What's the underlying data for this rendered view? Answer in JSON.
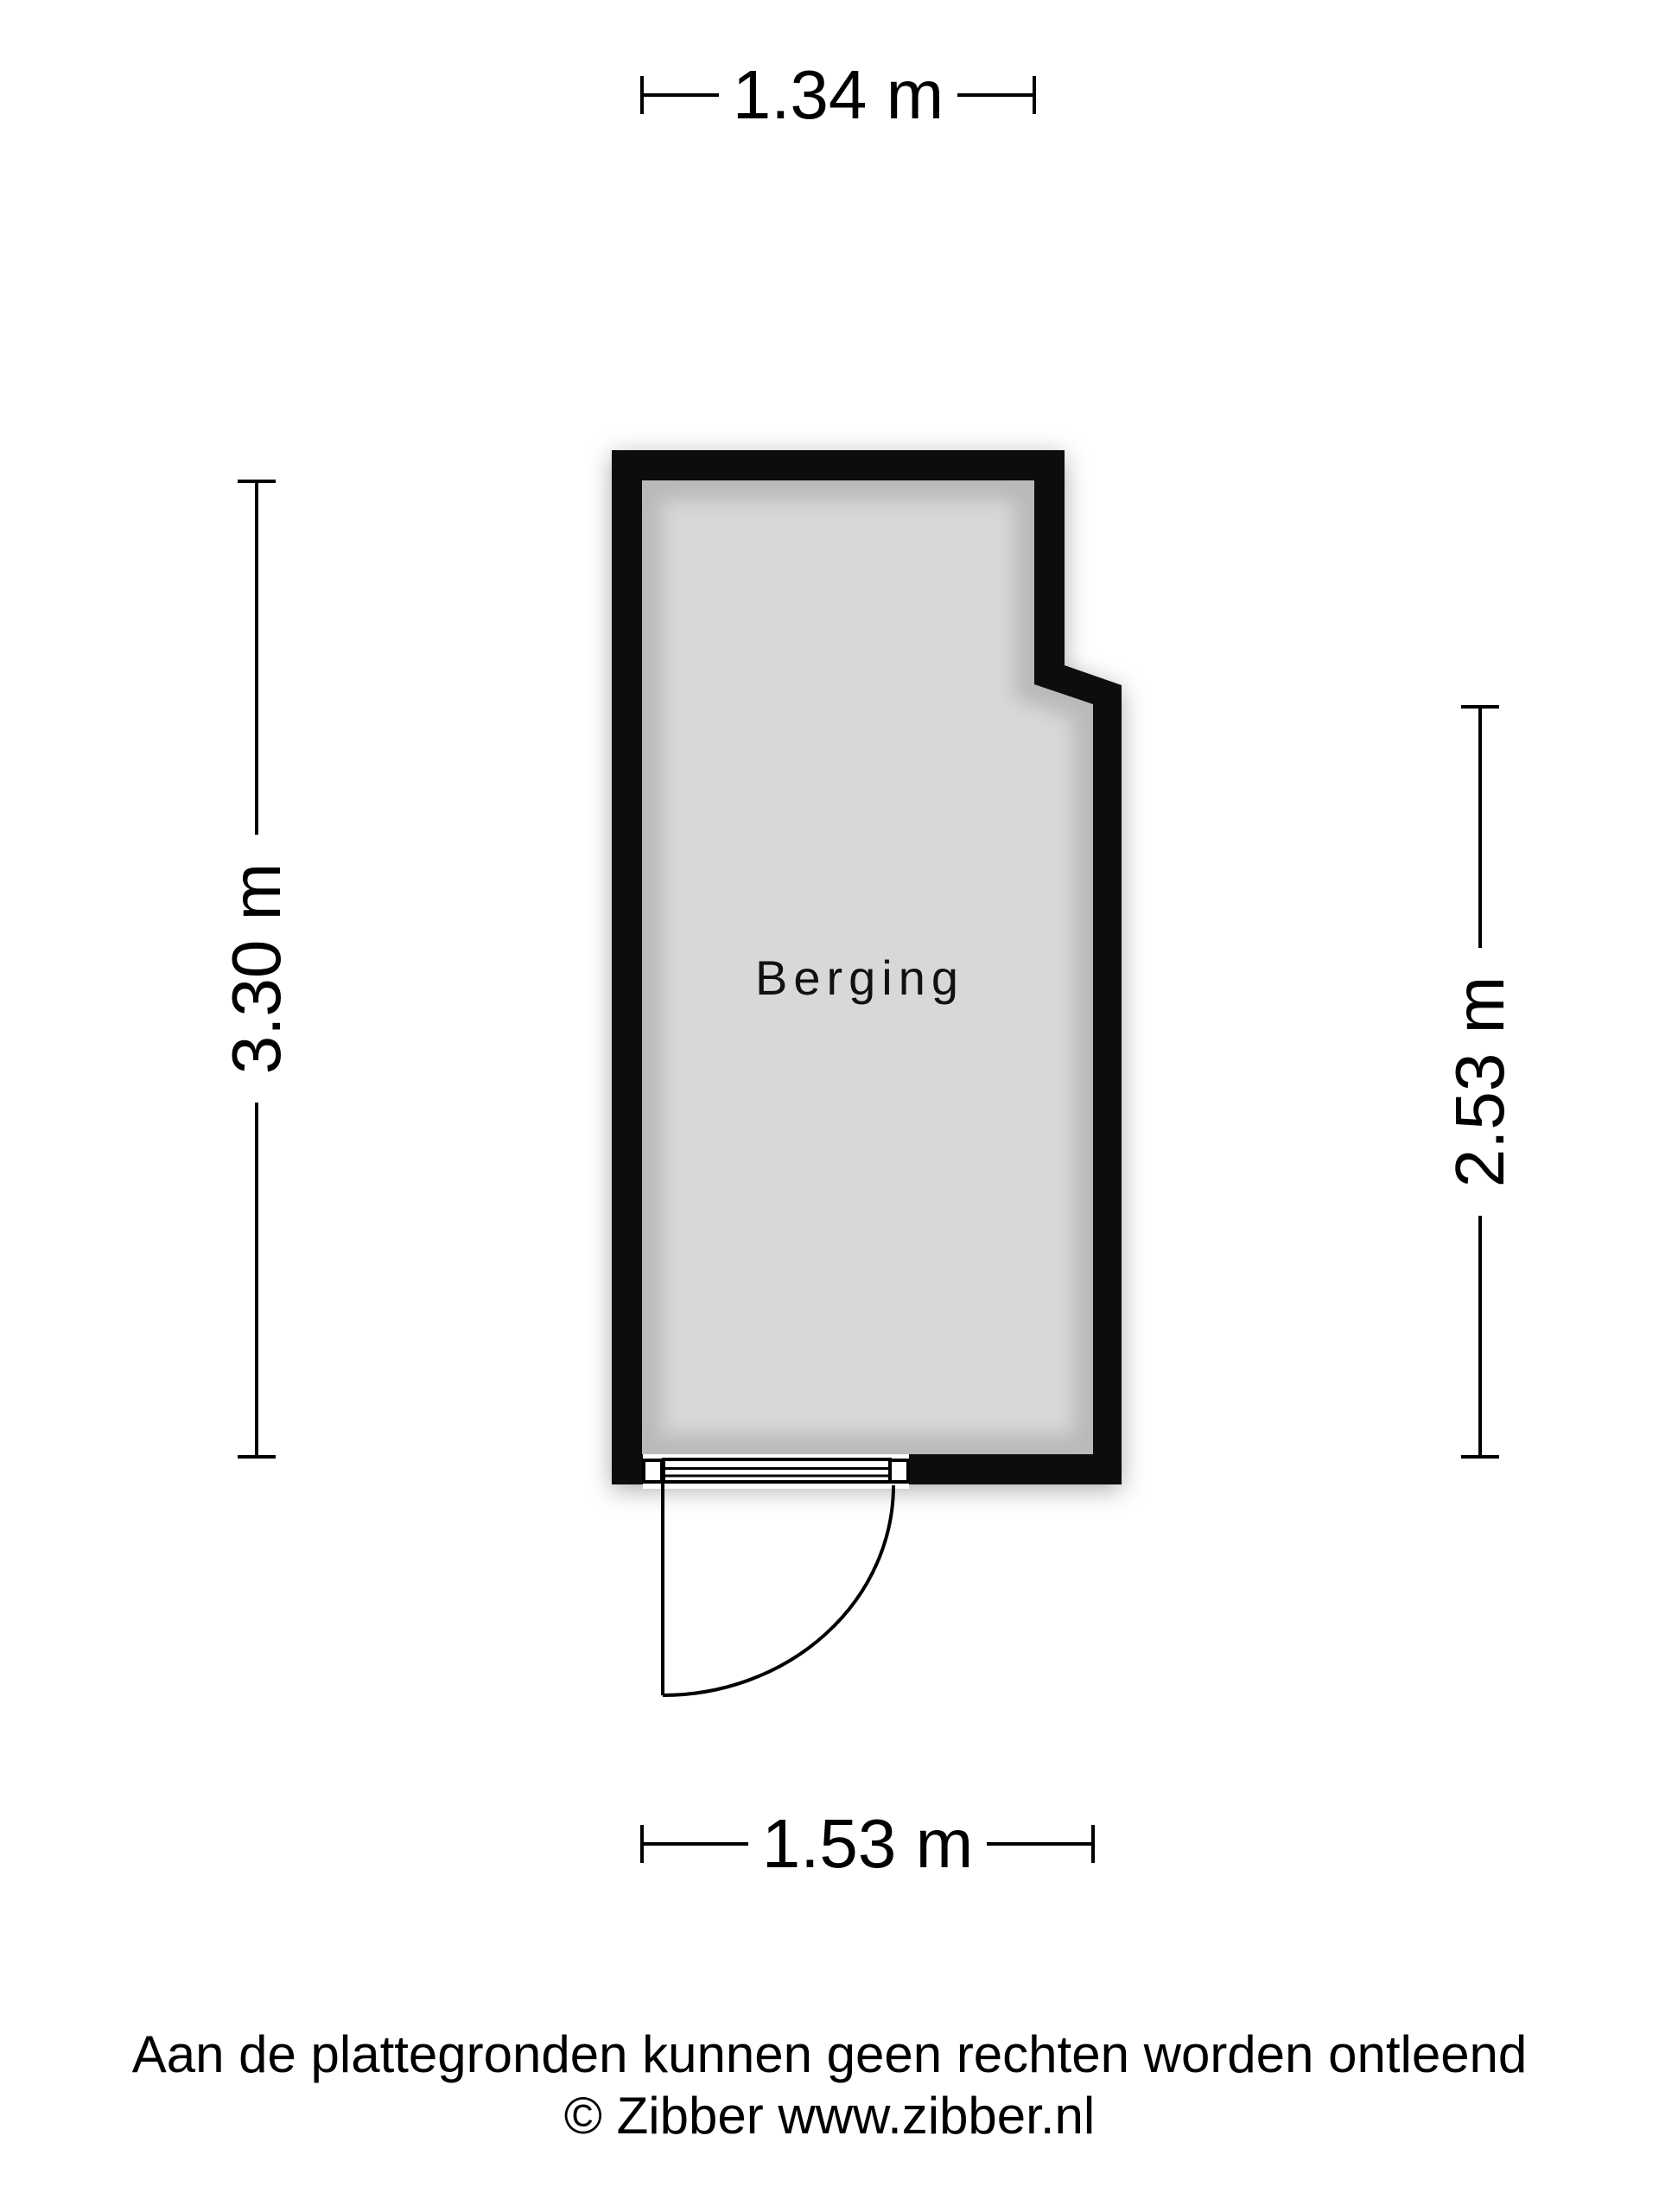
{
  "floorplan": {
    "room": {
      "label": "Berging"
    },
    "dimensions": {
      "top": "1.34 m",
      "left": "3.30 m",
      "right": "2.53 m",
      "bottom": "1.53 m"
    },
    "colors": {
      "wall": "#070707",
      "floor": "#d8d8d8",
      "line": "#000000",
      "background": "#ffffff"
    }
  },
  "footer": {
    "disclaimer": "Aan de plattegronden kunnen geen rechten worden ontleend",
    "copyright": "© Zibber www.zibber.nl"
  }
}
